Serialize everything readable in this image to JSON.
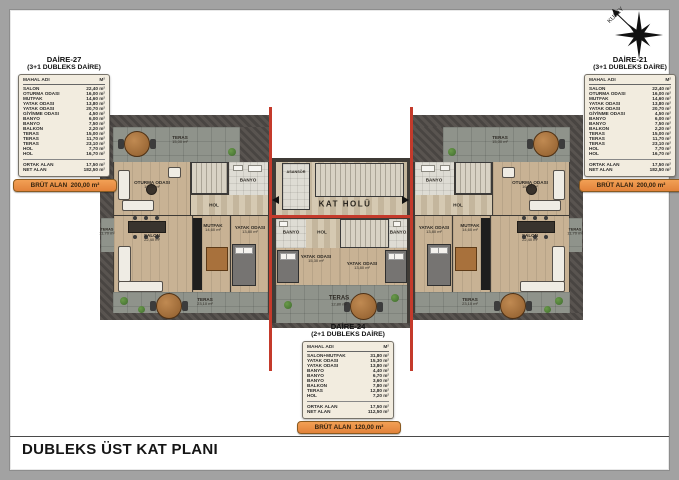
{
  "page": {
    "title": "DUBLEKS ÜST KAT PLANI"
  },
  "compass": {
    "label": "KUZEY"
  },
  "colors": {
    "red_section_line": "#c43a2b",
    "brut_banner": "#e8893a",
    "wood_floor": "#c8b294",
    "terrace": "#8f938b",
    "roof": "#54504a",
    "card_bg": "#f2ecdf"
  },
  "cards": {
    "daire27": {
      "name": "DAİRE-27",
      "type": "(3+1 DUBLEKS DAİRE)",
      "col_room": "MAHAL ADI",
      "col_area": "M²",
      "rows": [
        [
          "SALON",
          "22,40 m²"
        ],
        [
          "OTURMA ODASI",
          "16,00 m²"
        ],
        [
          "MUTFAK",
          "14,60 m²"
        ],
        [
          "YATAK ODASI",
          "13,80 m²"
        ],
        [
          "YATAK ODASI",
          "20,70 m²"
        ],
        [
          "GİYİNME ODASI",
          "4,50 m²"
        ],
        [
          "BANYO",
          "6,00 m²"
        ],
        [
          "BANYO",
          "7,50 m²"
        ],
        [
          "BALKON",
          "2,20 m²"
        ],
        [
          "TERAS",
          "15,00 m²"
        ],
        [
          "TERAS",
          "11,70 m²"
        ],
        [
          "TERAS",
          "23,10 m²"
        ],
        [
          "HOL",
          "7,70 m²"
        ],
        [
          "HOL",
          "16,70 m²"
        ]
      ],
      "summary": [
        [
          "ORTAK ALAN",
          "17,50 m²"
        ],
        [
          "NET ALAN",
          "182,50 m²"
        ]
      ],
      "brut_label": "BRÜT ALAN",
      "brut_value": "200,00 m²"
    },
    "daire21": {
      "name": "DAİRE-21",
      "type": "(3+1 DUBLEKS DAİRE)",
      "col_room": "MAHAL ADI",
      "col_area": "M²",
      "rows": [
        [
          "SALON",
          "22,40 m²"
        ],
        [
          "OTURMA ODASI",
          "16,00 m²"
        ],
        [
          "MUTFAK",
          "14,60 m²"
        ],
        [
          "YATAK ODASI",
          "13,80 m²"
        ],
        [
          "YATAK ODASI",
          "20,70 m²"
        ],
        [
          "GİYİNME ODASI",
          "4,50 m²"
        ],
        [
          "BANYO",
          "6,00 m²"
        ],
        [
          "BANYO",
          "7,50 m²"
        ],
        [
          "BALKON",
          "2,20 m²"
        ],
        [
          "TERAS",
          "15,00 m²"
        ],
        [
          "TERAS",
          "11,70 m²"
        ],
        [
          "TERAS",
          "23,10 m²"
        ],
        [
          "HOL",
          "7,70 m²"
        ],
        [
          "HOL",
          "16,70 m²"
        ]
      ],
      "summary": [
        [
          "ORTAK ALAN",
          "17,50 m²"
        ],
        [
          "NET ALAN",
          "182,50 m²"
        ]
      ],
      "brut_label": "BRÜT ALAN",
      "brut_value": "200,00 m²"
    },
    "daire24": {
      "name": "DAİRE-24",
      "type": "(2+1 DUBLEKS DAİRE)",
      "col_room": "MAHAL ADI",
      "col_area": "M²",
      "rows": [
        [
          "SALON+MUTFAK",
          "31,80 m²"
        ],
        [
          "YATAK ODASI",
          "15,30 m²"
        ],
        [
          "YATAK ODASI",
          "13,80 m²"
        ],
        [
          "BANYO",
          "4,40 m²"
        ],
        [
          "BANYO",
          "6,70 m²"
        ],
        [
          "BANYO",
          "3,60 m²"
        ],
        [
          "BALKON",
          "7,80 m²"
        ],
        [
          "TERAS",
          "12,80 m²"
        ],
        [
          "HOL",
          "7,20 m²"
        ]
      ],
      "summary": [
        [
          "ORTAK ALAN",
          "17,50 m²"
        ],
        [
          "NET ALAN",
          "112,50 m²"
        ]
      ],
      "brut_label": "BRÜT ALAN",
      "brut_value": "120,00 m²"
    }
  },
  "plan": {
    "labels": {
      "teras": "TERAS",
      "teras_top_area": "15,00 m²",
      "teras_side_area": "11,70 m²",
      "teras_bottom_area": "23,10 m²",
      "teras_mid_area": "12,80 m²",
      "oturma": "OTURMA ODASI",
      "oturma_area": "16,00 m²",
      "salon": "SALON",
      "salon_area": "22,40 m²",
      "mutfak": "MUTFAK",
      "mutfak_area": "14,60 m²",
      "yatak": "YATAK ODASI",
      "yatak_area": "13,80 m²",
      "yatak_mid_area": "15,30 m²",
      "banyo": "BANYO",
      "hol": "HOL",
      "kat_holu": "KAT HOLÜ",
      "asansor": "ASANSÖR"
    }
  }
}
